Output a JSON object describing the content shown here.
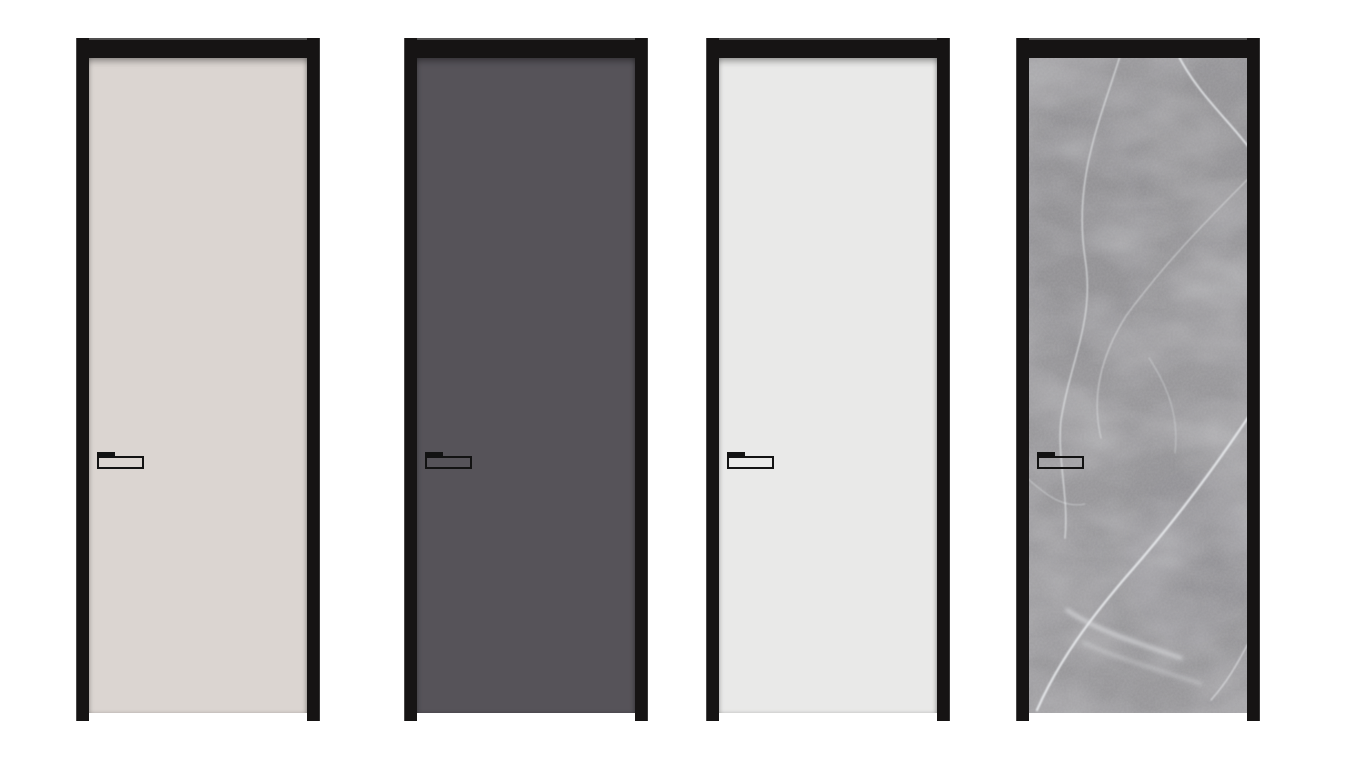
{
  "page": {
    "background_color": "#ffffff",
    "type": "product-render",
    "subject": "four framed interior doors, front view, white background"
  },
  "frame": {
    "color": "#161414",
    "edge_highlight": "#cfcfcf",
    "style": "slim black aluminium frame, open at bottom, jamb feet extend below slab"
  },
  "handle": {
    "color": "#121212",
    "style": "slim horizontal lever with latch tab, mounted near left stile at mid-height"
  },
  "doors": [
    {
      "id": "door-cream",
      "label": "cream matte door",
      "finish": "matte",
      "panel_color": "#dbd5d1"
    },
    {
      "id": "door-dark-gray",
      "label": "dark gray matte door",
      "finish": "matte",
      "panel_color": "#565359"
    },
    {
      "id": "door-white",
      "label": "off-white matte door",
      "finish": "matte",
      "panel_color": "#e9e9e8"
    },
    {
      "id": "door-marble",
      "label": "gray marble door",
      "finish": "marble",
      "panel_color": "#9a999c",
      "vein_color": "#eceff1"
    }
  ]
}
